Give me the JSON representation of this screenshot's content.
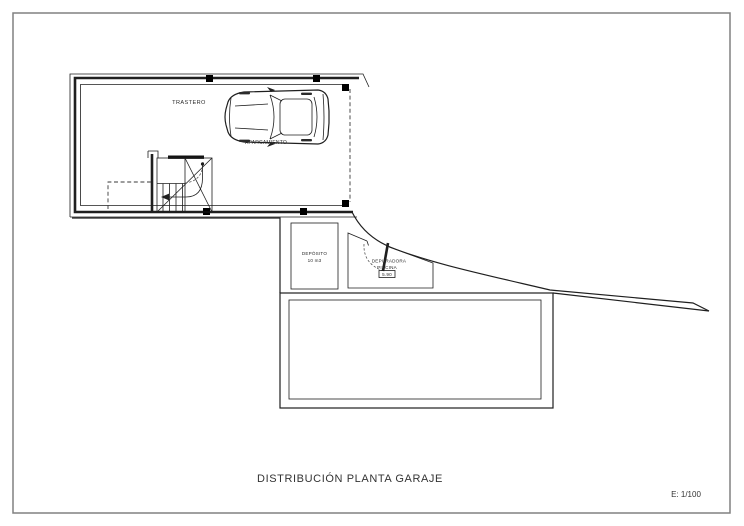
{
  "sheet": {
    "title": "DISTRIBUCIÓN PLANTA GARAJE",
    "scale": "E: 1/100"
  },
  "plan": {
    "rooms": {
      "trastero_label": "TRASTERO",
      "aparcamiento_label": "APARCAMIENTO",
      "deposito_label_line1": "DEPÓSITO",
      "deposito_label_line2": "10 m3",
      "depuradora_label_line1": "DEPURADORA",
      "depuradora_label_line2": "PISCINA",
      "depuradora_level": "5.90"
    },
    "colors": {
      "line": "#1f1f1f",
      "border": "#808080",
      "background": "#ffffff"
    }
  }
}
